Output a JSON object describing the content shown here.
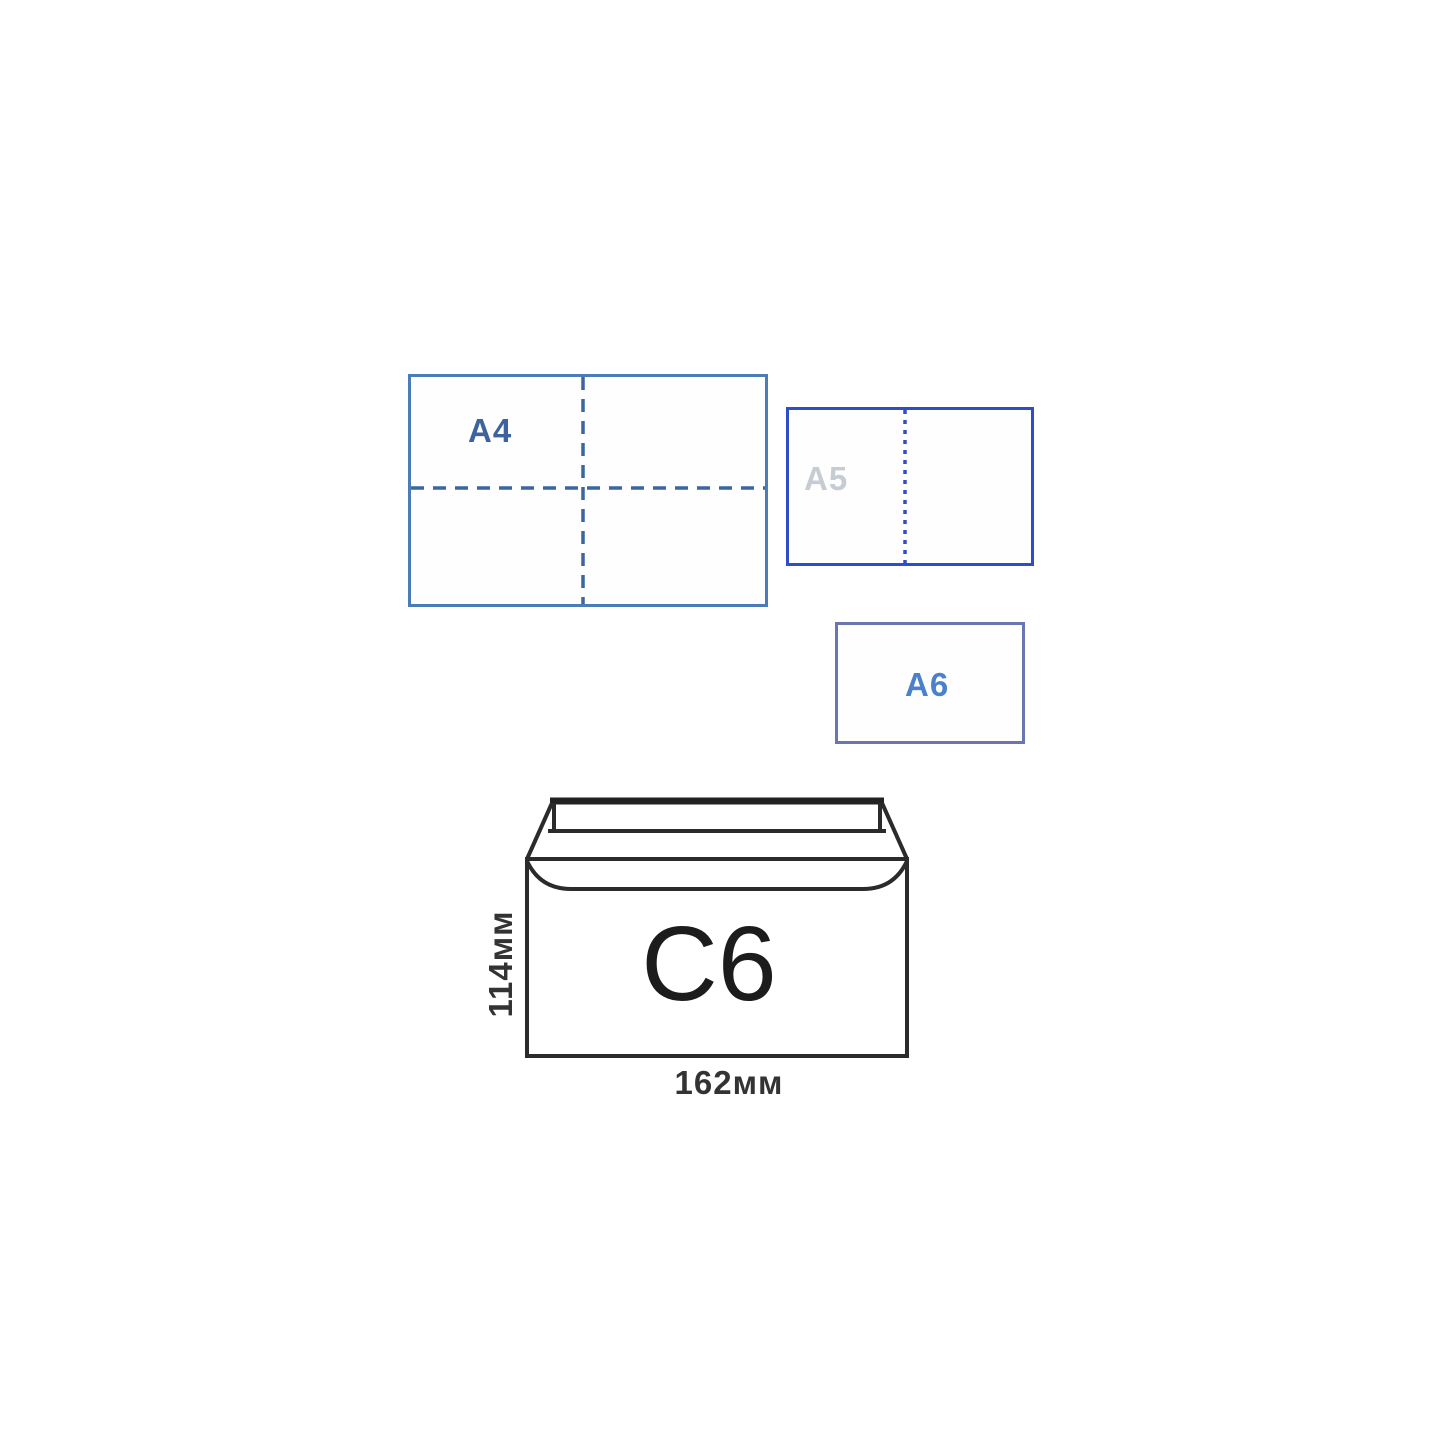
{
  "papers": {
    "a4": {
      "label": "A4",
      "border_color": "#4a7db8",
      "fold_line_color": "#3a679f",
      "label_color": "#3d639e",
      "fold_pattern": "dashed horizontal and vertical center lines (quarter fold)"
    },
    "a5": {
      "label": "A5",
      "border_color": "#2e4ec5",
      "fold_line_color": "#2e4ec5",
      "label_color": "#c6ccd4",
      "fold_pattern": "dotted vertical center line (half fold)"
    },
    "a6": {
      "label": "A6",
      "border_color": "#6b76b0",
      "label_color": "#4b80ca"
    }
  },
  "envelope": {
    "label": "C6",
    "height_label": "114мм",
    "width_label": "162мм",
    "outline_color": "#2b2b2b",
    "flap_top_color": "#222222",
    "label_color": "#1c1c1c",
    "dimension_color": "#333333"
  }
}
